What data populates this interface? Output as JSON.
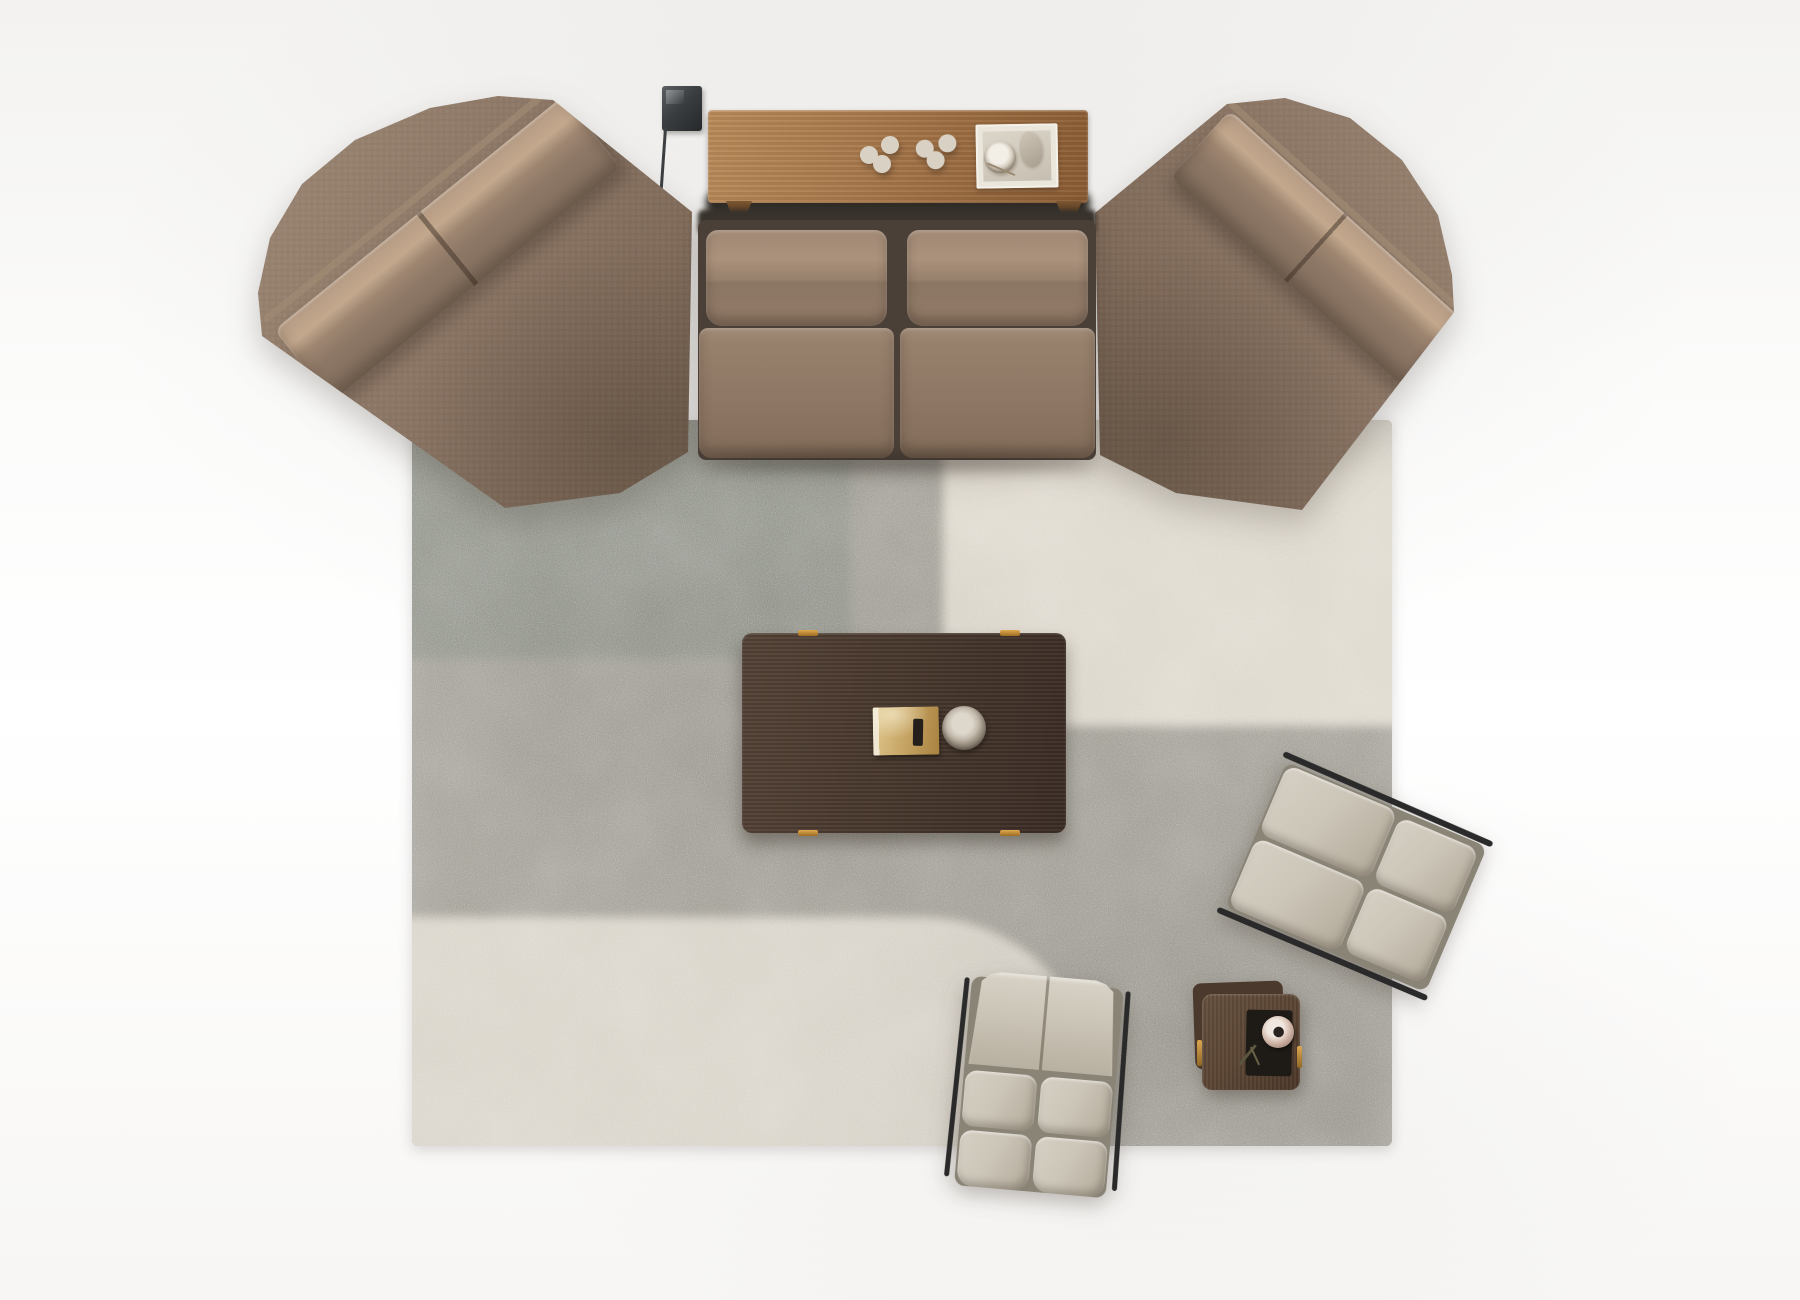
{
  "scene": {
    "description": "Top-down 3D render of a modular living-room furniture arrangement on a patchwork rug over a white floor",
    "floor_color": "#fafaf9"
  },
  "palette": {
    "floor": "#fafaf9",
    "sofa_base": "#8c7665",
    "sofa_light": "#b59b84",
    "sofa_dark": "#77624f",
    "sofa_deep": "#6a5747",
    "wood_console": "#a9794c",
    "wood_console_dark": "#8a5c33",
    "wood_coffee": "#4a3a2f",
    "wood_coffee_dark": "#3c2e26",
    "wood_side": "#5d4736",
    "rug_gray": "#9e9b92",
    "rug_sage": "#8e9187",
    "rug_cream": "#dcd6ca",
    "rug_cream_bottom": "#d8d2c7",
    "chair_greige": "#ccc6b9",
    "chair_greige_dark": "#aba494",
    "frame_black": "#2a2a2a",
    "brass": "#c08e3f",
    "decor_cream": "#d9d1c3",
    "lamp_dark": "#383c3e",
    "book_gold": "#c9a869"
  },
  "objects": {
    "sofa_left_module": {
      "label": "Angled corner sofa module (left)",
      "upholstery": "taupe brown fabric",
      "back_cushions": 2
    },
    "sofa_center": {
      "label": "Two-seat center sofa",
      "seats": 2,
      "upholstery": "taupe brown fabric"
    },
    "sofa_right_module": {
      "label": "Angled corner sofa module (right)",
      "upholstery": "taupe brown fabric",
      "back_cushions": 2
    },
    "console_table": {
      "label": "Walnut console table behind center sofa",
      "decor": [
        "rope knot sculpture",
        "rope knot sculpture",
        "square tray with bowl and small sculpture"
      ]
    },
    "wall_lamp": {
      "label": "Black reading floor lamp",
      "parts": [
        "square head plate",
        "thin stem",
        "cylinder shade"
      ]
    },
    "rug": {
      "label": "Patchwork area rug",
      "patches": [
        "sage gray",
        "stone gray",
        "cream column",
        "cream rounded block"
      ]
    },
    "coffee_table": {
      "label": "Espresso rectangular coffee table with brass hinges",
      "items": [
        "gold-cover book",
        "ceramic bowl"
      ]
    },
    "lounge_chair_right": {
      "label": "Greige lounge chair, rotated, right side",
      "cushions": 4,
      "frame": "black metal"
    },
    "lounge_chair_bottom": {
      "label": "Greige lounge chair, bottom center",
      "cushions": 5,
      "frame": "black metal side rails"
    },
    "side_table": {
      "label": "Dark wood square side table",
      "items": [
        "black tray",
        "rose ceramic vase",
        "dried sprigs"
      ],
      "hardware": "brass handles"
    }
  }
}
